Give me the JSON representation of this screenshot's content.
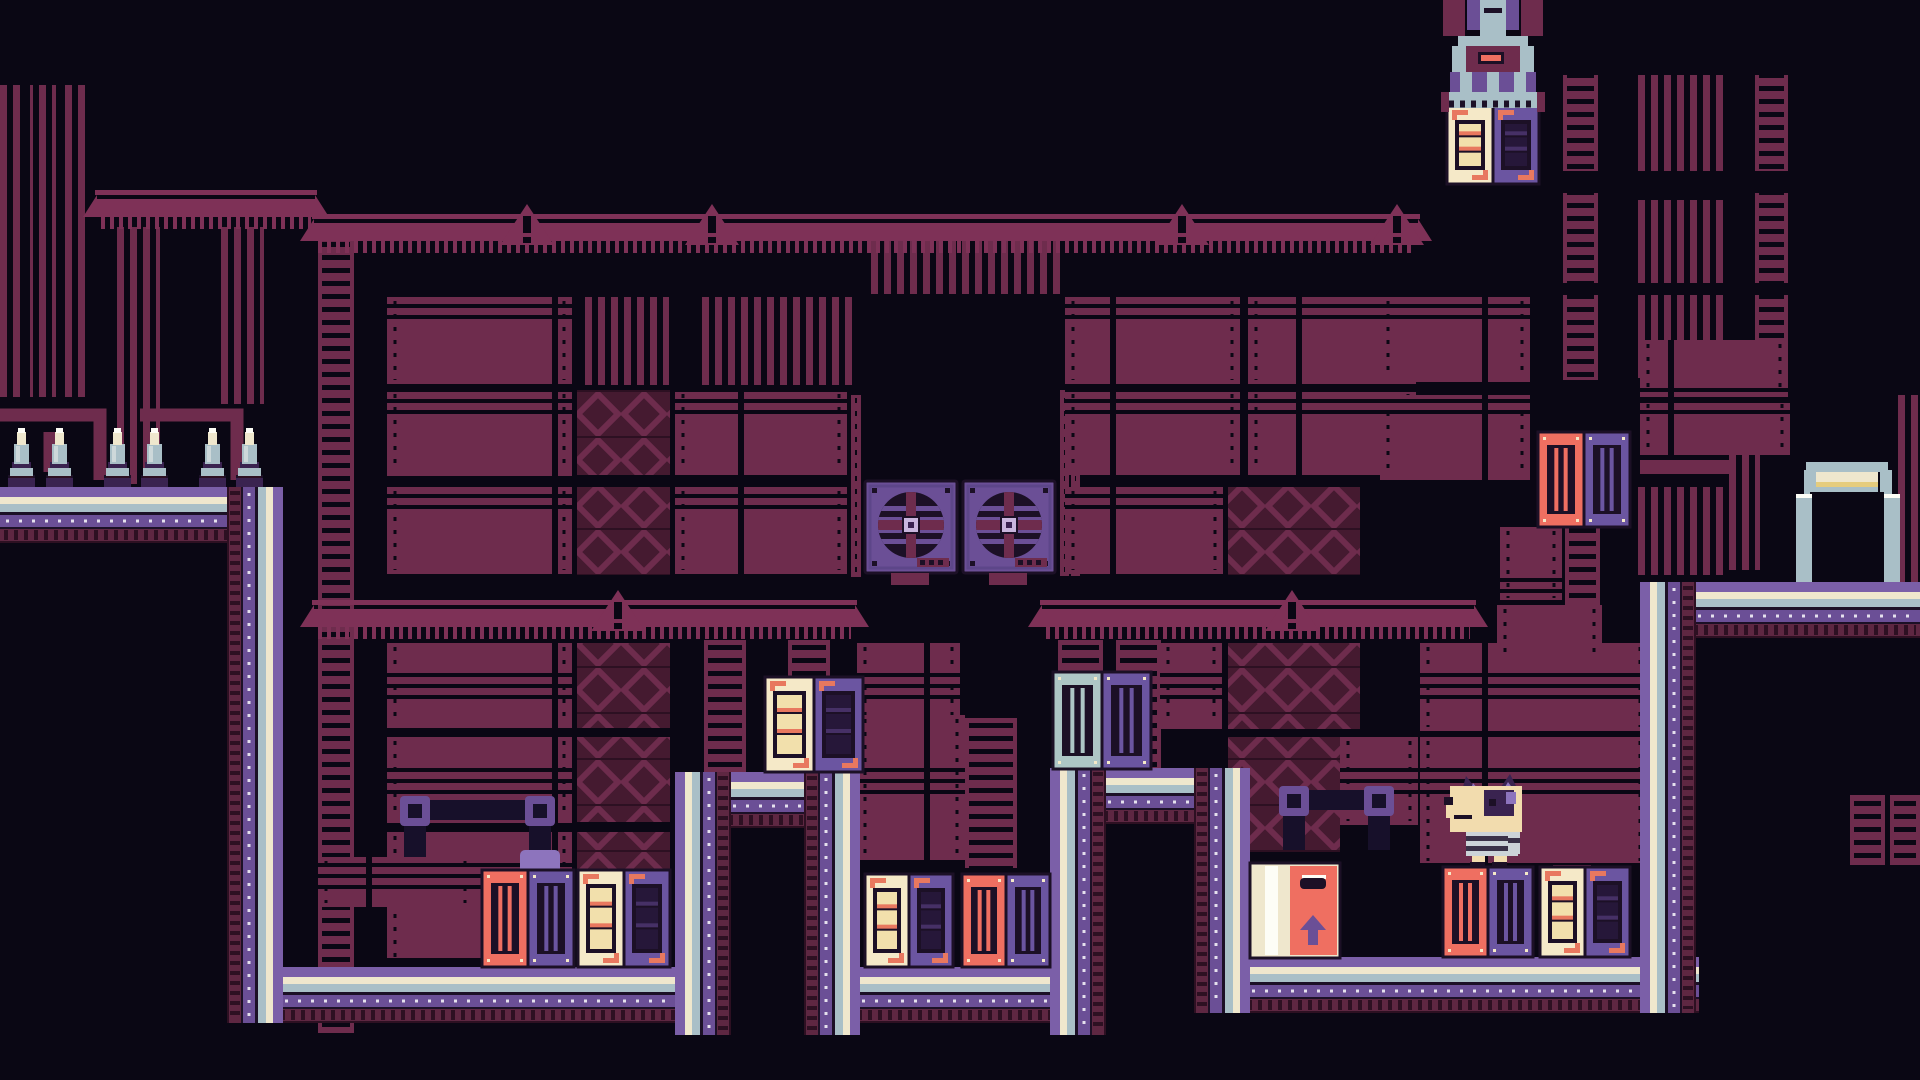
{
  "meta": {
    "app": "pixel-platformer-level",
    "hud_text": ""
  },
  "palette": {
    "bg": "#0a0714",
    "ink": "#1c1026",
    "deep": "#2d1022",
    "maroonDark": "#451a30",
    "maroon": "#6e2c4d",
    "maroonHi": "#7e3157",
    "plum": "#5e2742",
    "purple": "#6b4f96",
    "purpleHi": "#8d74bd",
    "band": "#7b5fa8",
    "lav": "#c9b6dd",
    "purpleDeep": "#3a2350",
    "cratePurple": "#6b55a1",
    "steel": "#a9bfc7",
    "steelHi": "#cdd8da",
    "cream": "#efe7cd",
    "white": "#fdfdf6",
    "crateCream": "#f5e9c8",
    "panelFill": "#f2e0ac",
    "salmon": "#ef6f61",
    "orange": "#e8785f",
    "teal": "#aec6c6",
    "gold": "#e5cc7d",
    "shirtLight": "#ccd3d8",
    "shirtDark": "#3a3148",
    "charCream": "#f2dcae",
    "pipeDark": "#17102a"
  },
  "scene": {
    "width": 1920,
    "height": 1080,
    "walls": [
      [
        "corrug",
        0,
        85,
        26,
        312
      ],
      [
        "corrug",
        30,
        85,
        26,
        312
      ],
      [
        "corrug",
        60,
        85,
        26,
        312
      ],
      [
        "corrug",
        114,
        227,
        46,
        257
      ],
      [
        "corrug",
        218,
        227,
        46,
        177
      ],
      [
        "corrug",
        579,
        297,
        90,
        88
      ],
      [
        "corrug",
        700,
        297,
        157,
        88
      ],
      [
        "corrug",
        865,
        240,
        196,
        54
      ],
      [
        "corrug",
        1635,
        75,
        88,
        96
      ],
      [
        "corrug",
        1635,
        200,
        88,
        83
      ],
      [
        "corrug",
        1635,
        295,
        88,
        83
      ],
      [
        "corrug",
        1633,
        487,
        92,
        88
      ],
      [
        "corrug",
        1898,
        395,
        22,
        192
      ],
      [
        "corrug",
        1725,
        420,
        35,
        150
      ],
      [
        "ladder",
        318,
        233,
        36,
        800
      ],
      [
        "ladder",
        851,
        395,
        10,
        182
      ],
      [
        "ladder",
        1060,
        390,
        9,
        186
      ],
      [
        "ladder",
        1071,
        390,
        9,
        186
      ],
      [
        "ladder",
        1563,
        75,
        35,
        96
      ],
      [
        "ladder",
        1563,
        193,
        35,
        90
      ],
      [
        "ladder",
        1563,
        295,
        35,
        85
      ],
      [
        "ladder",
        1755,
        75,
        33,
        96
      ],
      [
        "ladder",
        1755,
        193,
        33,
        90
      ],
      [
        "ladder",
        1755,
        295,
        33,
        85
      ],
      [
        "ladder",
        965,
        718,
        52,
        150
      ],
      [
        "ladder",
        1553,
        745,
        38,
        212
      ],
      [
        "ladder",
        1565,
        527,
        35,
        158
      ],
      [
        "ladder",
        1850,
        795,
        35,
        70
      ],
      [
        "ladder",
        1890,
        795,
        30,
        70
      ],
      [
        "ladder",
        704,
        640,
        42,
        132
      ],
      [
        "ladder",
        788,
        640,
        42,
        132
      ],
      [
        "ladder",
        1058,
        640,
        45,
        128
      ],
      [
        "ladder",
        1116,
        640,
        45,
        128
      ],
      [
        "plank",
        387,
        297,
        185,
        87
      ],
      [
        "plank",
        387,
        390,
        185,
        86
      ],
      [
        "plank",
        387,
        487,
        185,
        87
      ],
      [
        "plank",
        387,
        643,
        185,
        85
      ],
      [
        "plank",
        387,
        737,
        185,
        86
      ],
      [
        "plank",
        387,
        832,
        185,
        130
      ],
      [
        "plank",
        675,
        390,
        172,
        85
      ],
      [
        "plank",
        675,
        487,
        172,
        87
      ],
      [
        "plank",
        857,
        643,
        103,
        85
      ],
      [
        "plank",
        857,
        715,
        108,
        145
      ],
      [
        "plank",
        1065,
        297,
        175,
        87
      ],
      [
        "plank",
        1248,
        297,
        168,
        87
      ],
      [
        "plank",
        1065,
        390,
        175,
        85
      ],
      [
        "plank",
        1065,
        487,
        158,
        87
      ],
      [
        "plank",
        1248,
        390,
        168,
        85
      ],
      [
        "plank",
        1380,
        297,
        150,
        85
      ],
      [
        "plank",
        1380,
        395,
        150,
        85
      ],
      [
        "plank",
        1160,
        643,
        62,
        86
      ],
      [
        "plank",
        1340,
        737,
        78,
        88
      ],
      [
        "plank",
        1420,
        643,
        228,
        88
      ],
      [
        "plank",
        1420,
        737,
        228,
        128
      ],
      [
        "plank",
        1640,
        340,
        148,
        57
      ],
      [
        "plank",
        1640,
        400,
        150,
        55
      ],
      [
        "plank",
        318,
        857,
        155,
        50
      ],
      [
        "plank",
        1497,
        605,
        105,
        58
      ],
      [
        "plank",
        1500,
        527,
        62,
        75
      ],
      [
        "xpanel",
        577,
        390,
        93,
        85
      ],
      [
        "xpanel",
        577,
        487,
        93,
        88
      ],
      [
        "xpanel",
        577,
        643,
        93,
        85
      ],
      [
        "xpanel",
        577,
        737,
        93,
        85
      ],
      [
        "xpanel",
        577,
        832,
        93,
        128
      ],
      [
        "xpanel",
        1228,
        487,
        132,
        88
      ],
      [
        "xpanel",
        1228,
        643,
        132,
        86
      ],
      [
        "xpanel",
        1228,
        737,
        112,
        115
      ]
    ],
    "girders": [
      {
        "x": 95,
        "y": 190,
        "w": 222,
        "tri": []
      },
      {
        "x": 312,
        "y": 214,
        "w": 1108,
        "tri": [
          527,
          712,
          1182,
          1397
        ]
      },
      {
        "x": 312,
        "y": 600,
        "w": 545,
        "tri": [
          618
        ]
      },
      {
        "x": 1040,
        "y": 600,
        "w": 436,
        "tri": [
          1292
        ]
      }
    ],
    "pipes": [
      {
        "pts": [
          [
            0,
            415
          ],
          [
            100,
            415
          ],
          [
            100,
            480
          ]
        ],
        "w": 13,
        "c": "maroon"
      },
      {
        "pts": [
          [
            140,
            415
          ],
          [
            237,
            415
          ],
          [
            237,
            480
          ]
        ],
        "w": 13,
        "c": "maroon"
      },
      {
        "pts": [
          [
            50,
            432
          ],
          [
            50,
            472
          ]
        ],
        "w": 13,
        "c": "maroon"
      },
      {
        "pts": [
          [
            1640,
            467
          ],
          [
            1733,
            467
          ]
        ],
        "w": 14,
        "c": "maroon"
      }
    ],
    "elbows": [
      {
        "x": 404,
        "y": 800,
        "w": 147,
        "h": 57
      },
      {
        "x": 1283,
        "y": 790,
        "w": 107,
        "h": 60
      }
    ],
    "deco": [
      [
        520,
        850,
        40,
        30
      ],
      [
        1443,
        933,
        36,
        30
      ],
      [
        1484,
        944,
        42,
        20
      ]
    ],
    "fans": [
      {
        "x": 865,
        "y": 481,
        "s": 92
      },
      {
        "x": 963,
        "y": 481,
        "s": 92
      }
    ],
    "path": {
      "stripes": [
        [
          "band",
          10
        ],
        [
          "cream",
          7
        ],
        [
          "steel",
          8
        ],
        [
          "ink",
          3
        ],
        [
          "purple",
          12
        ],
        [
          "ink",
          2
        ],
        [
          "plum",
          12
        ],
        [
          "deep",
          2
        ]
      ],
      "segments": [
        {
          "x": 0,
          "y": 487,
          "w": 283,
          "h": 56,
          "outer": "top"
        },
        {
          "x": 227,
          "y": 967,
          "w": 460,
          "h": 56,
          "outer": "top"
        },
        {
          "x": 675,
          "y": 772,
          "w": 185,
          "h": 56,
          "outer": "top"
        },
        {
          "x": 804,
          "y": 967,
          "w": 302,
          "h": 56,
          "outer": "top"
        },
        {
          "x": 1050,
          "y": 768,
          "w": 200,
          "h": 56,
          "outer": "top"
        },
        {
          "x": 1194,
          "y": 957,
          "w": 505,
          "h": 56,
          "outer": "top"
        },
        {
          "x": 1640,
          "y": 582,
          "w": 280,
          "h": 56,
          "outer": "top"
        },
        {
          "x": 227,
          "y": 487,
          "w": 56,
          "h": 536,
          "outer": "right"
        },
        {
          "x": 675,
          "y": 772,
          "w": 56,
          "h": 263,
          "outer": "left"
        },
        {
          "x": 804,
          "y": 772,
          "w": 56,
          "h": 263,
          "outer": "right"
        },
        {
          "x": 1050,
          "y": 768,
          "w": 56,
          "h": 267,
          "outer": "left"
        },
        {
          "x": 1194,
          "y": 768,
          "w": 56,
          "h": 245,
          "outer": "right"
        },
        {
          "x": 1640,
          "y": 582,
          "w": 56,
          "h": 431,
          "outer": "left"
        }
      ]
    },
    "spikes": {
      "baseY": 487,
      "w": 27,
      "h": 60,
      "xs": [
        8,
        46,
        104,
        141,
        199,
        236
      ]
    },
    "crates": [
      {
        "kind": "vent",
        "x": 482,
        "y": 870,
        "w": 92,
        "h": 97,
        "halves": [
          "salmon",
          "cratePurple"
        ]
      },
      {
        "kind": "panel",
        "x": 578,
        "y": 870,
        "w": 92,
        "h": 97,
        "halves": [
          "crateCream",
          "cratePurple"
        ]
      },
      {
        "kind": "panel",
        "x": 765,
        "y": 677,
        "w": 98,
        "h": 95,
        "halves": [
          "crateCream",
          "cratePurple"
        ]
      },
      {
        "kind": "panel",
        "x": 865,
        "y": 874,
        "w": 88,
        "h": 93,
        "halves": [
          "crateCream",
          "cratePurple"
        ]
      },
      {
        "kind": "vent",
        "x": 962,
        "y": 874,
        "w": 88,
        "h": 93,
        "halves": [
          "salmon",
          "cratePurple"
        ]
      },
      {
        "kind": "vent",
        "x": 1053,
        "y": 672,
        "w": 98,
        "h": 97,
        "halves": [
          "teal",
          "cratePurple"
        ]
      },
      {
        "kind": "arrow",
        "x": 1250,
        "y": 863,
        "w": 90,
        "h": 95
      },
      {
        "kind": "vent",
        "x": 1443,
        "y": 867,
        "w": 90,
        "h": 90,
        "halves": [
          "salmon",
          "cratePurple"
        ]
      },
      {
        "kind": "panel",
        "x": 1540,
        "y": 867,
        "w": 90,
        "h": 90,
        "halves": [
          "crateCream",
          "cratePurple"
        ]
      },
      {
        "kind": "vent",
        "x": 1538,
        "y": 432,
        "w": 92,
        "h": 95,
        "halves": [
          "salmon",
          "cratePurple"
        ]
      },
      {
        "kind": "panel",
        "x": 1447,
        "y": 106,
        "w": 92,
        "h": 78,
        "halves": [
          "crateCream",
          "cratePurple"
        ]
      }
    ],
    "machine": {
      "rects": [
        [
          1443,
          0,
          22,
          36,
          "maroon"
        ],
        [
          1521,
          0,
          22,
          36,
          "maroon"
        ],
        [
          1467,
          0,
          13,
          30,
          "purple"
        ],
        [
          1506,
          0,
          13,
          30,
          "purple"
        ],
        [
          1480,
          0,
          26,
          40,
          "steel"
        ],
        [
          1484,
          8,
          18,
          5,
          "ink"
        ],
        [
          1458,
          36,
          70,
          10,
          "steel"
        ],
        [
          1452,
          46,
          14,
          26,
          "steel"
        ],
        [
          1520,
          46,
          14,
          26,
          "steel"
        ],
        [
          1466,
          46,
          54,
          26,
          "maroon"
        ],
        [
          1478,
          52,
          26,
          12,
          "ink"
        ],
        [
          1481,
          55,
          20,
          6,
          "salmon"
        ],
        [
          1450,
          72,
          86,
          20,
          "purple"
        ],
        [
          1460,
          72,
          12,
          20,
          "steel"
        ],
        [
          1487,
          72,
          12,
          20,
          "steel"
        ],
        [
          1514,
          72,
          12,
          20,
          "steel"
        ],
        [
          1441,
          92,
          104,
          16,
          "steel"
        ],
        [
          1441,
          92,
          8,
          20,
          "maroon"
        ],
        [
          1537,
          92,
          8,
          20,
          "maroon"
        ]
      ],
      "teethY": 104,
      "teethX1": 1449,
      "teethX2": 1537
    },
    "door": {
      "rects": [
        [
          1806,
          462,
          82,
          10,
          "steel"
        ],
        [
          1804,
          470,
          12,
          42,
          "steel"
        ],
        [
          1880,
          470,
          12,
          42,
          "steel"
        ],
        [
          1816,
          472,
          62,
          10,
          "cream"
        ],
        [
          1816,
          482,
          62,
          5,
          "gold"
        ],
        [
          1816,
          487,
          62,
          5,
          "steel"
        ],
        [
          1810,
          492,
          74,
          90,
          "bg"
        ],
        [
          1796,
          494,
          16,
          6,
          "white"
        ],
        [
          1884,
          494,
          16,
          6,
          "white"
        ],
        [
          1796,
          498,
          16,
          84,
          "steel"
        ],
        [
          1884,
          498,
          16,
          84,
          "steel"
        ]
      ]
    },
    "character": {
      "tris": [
        {
          "pts": "1460,798 1466,776 1480,794",
          "c": "purpleDeep"
        },
        {
          "pts": "1469,795 1473,783 1481,793",
          "c": "purpleHi"
        },
        {
          "pts": "1496,794 1510,774 1522,798",
          "c": "purpleDeep"
        },
        {
          "pts": "1502,792 1508,782 1516,793",
          "c": "purpleHi"
        }
      ],
      "rects": [
        [
          1450,
          786,
          72,
          46,
          "charCream"
        ],
        [
          1446,
          800,
          24,
          18,
          "charCream"
        ],
        [
          1444,
          797,
          9,
          8,
          "ink"
        ],
        [
          1484,
          790,
          30,
          26,
          "purpleDeep"
        ],
        [
          1506,
          792,
          10,
          12,
          "purpleHi"
        ],
        [
          1489,
          799,
          7,
          7,
          "ink"
        ],
        [
          1454,
          815,
          18,
          4,
          "ink"
        ],
        [
          1466,
          832,
          52,
          24,
          "shirtLight"
        ],
        [
          1466,
          836,
          52,
          5,
          "shirtDark"
        ],
        [
          1466,
          846,
          52,
          5,
          "shirtDark"
        ],
        [
          1508,
          832,
          12,
          22,
          "shirtLight"
        ],
        [
          1508,
          838,
          12,
          5,
          "shirtDark"
        ],
        [
          1472,
          856,
          13,
          8,
          "charCream"
        ],
        [
          1494,
          856,
          13,
          8,
          "charCream"
        ],
        [
          1470,
          862,
          15,
          5,
          "ink"
        ],
        [
          1492,
          862,
          15,
          5,
          "ink"
        ]
      ]
    }
  }
}
